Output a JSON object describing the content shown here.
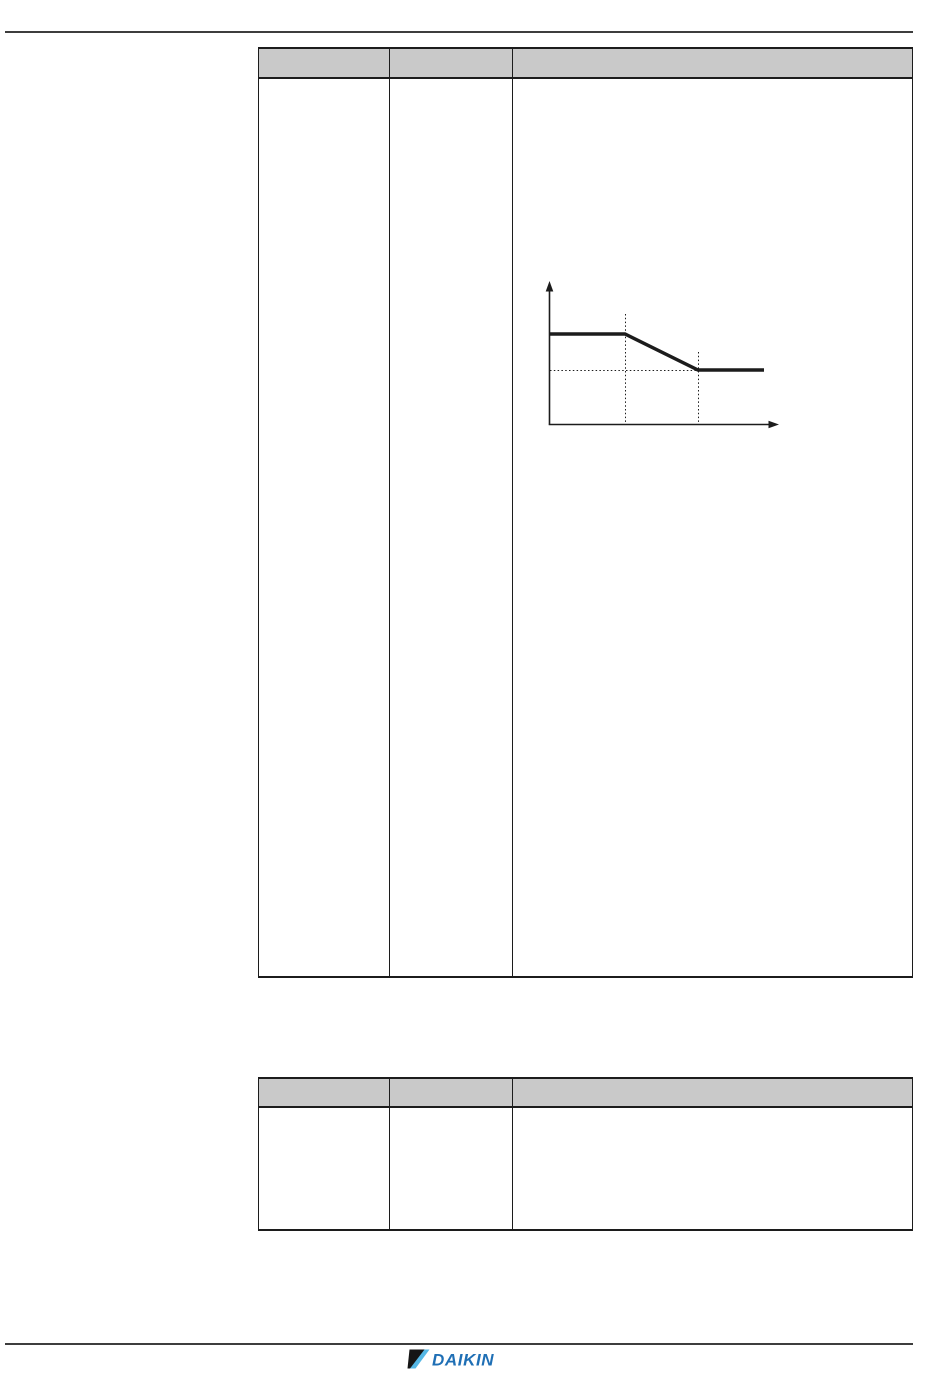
{
  "page": {
    "background": "#ffffff",
    "rule_color": "#3d3d3d",
    "table_border_color": "#1c1c1c",
    "table_header_fill": "#c9c9c9"
  },
  "table_top": {
    "columns": [
      "",
      "",
      ""
    ],
    "rows": [
      [
        "",
        "",
        ""
      ]
    ]
  },
  "table_bottom": {
    "columns": [
      "",
      "",
      ""
    ],
    "rows": [
      [
        "",
        "",
        ""
      ]
    ]
  },
  "chart_data": {
    "type": "line",
    "title": "",
    "xlabel": "",
    "ylabel": "",
    "legend": [],
    "axes": {
      "x0": 549.5,
      "y_bottom": 424.5,
      "x_right": 779,
      "y_top": 281
    },
    "curve_points": [
      [
        550,
        334
      ],
      [
        625,
        334
      ],
      [
        698,
        370
      ],
      [
        764,
        370
      ]
    ],
    "guides_vertical": [
      {
        "x": 625.5,
        "y1": 314,
        "y2": 424
      },
      {
        "x": 698.5,
        "y1": 352,
        "y2": 424
      }
    ],
    "guide_horizontal": {
      "y": 370.5,
      "x1": 550,
      "x2": 698
    },
    "line_color": "#1c1c1c"
  },
  "footer": {
    "logo_text": "DAIKIN",
    "logo_text_color": "#1f6fb5",
    "logo_mark_black": "#151515",
    "logo_mark_cyan": "#55b7e5"
  }
}
